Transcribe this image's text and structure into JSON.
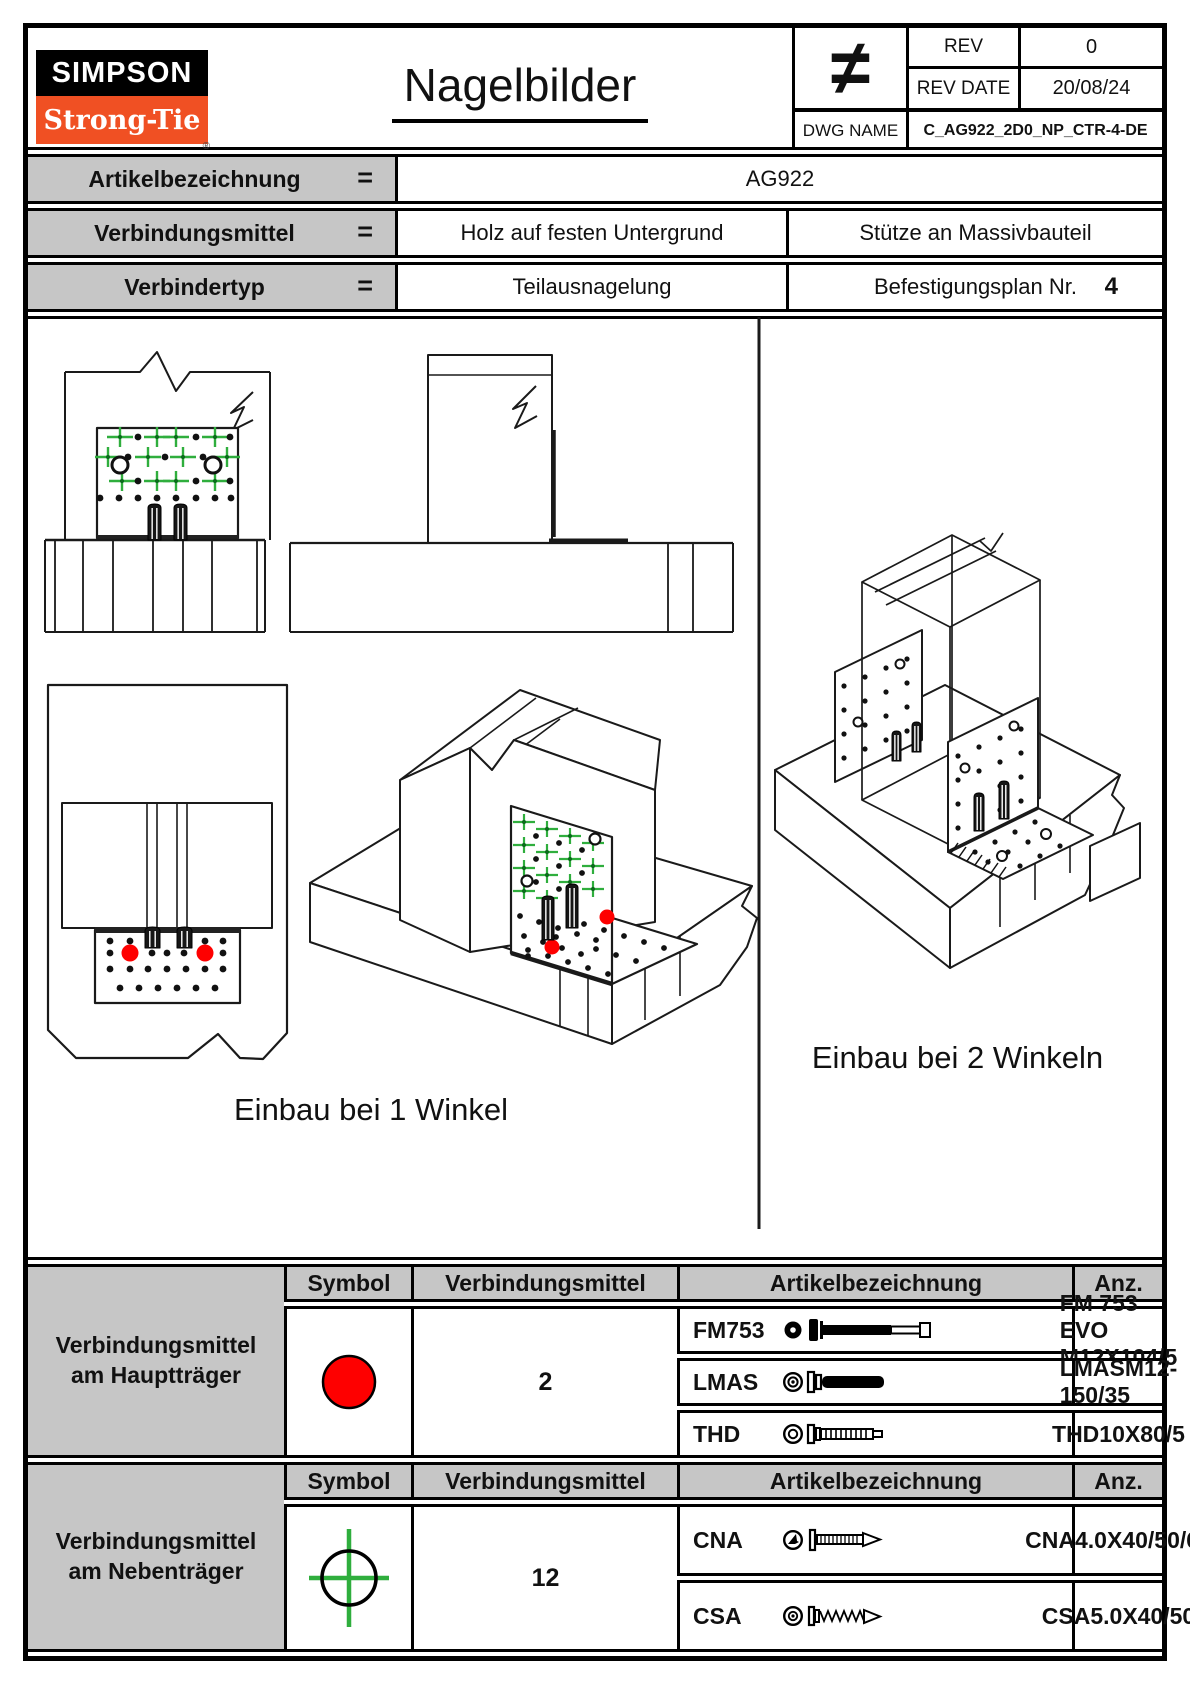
{
  "header": {
    "logo_line1": "SIMPSON",
    "logo_line2": "Strong-Tie",
    "registered_mark": "®",
    "title": "Nagelbilder",
    "symbol": "≠",
    "rev_label": "REV",
    "rev_value": "0",
    "rev_date_label": "REV DATE",
    "rev_date_value": "20/08/24",
    "dwg_label": "DWG NAME",
    "dwg_value": "C_AG922_2D0_NP_CTR-4-DE"
  },
  "info": {
    "rows": [
      {
        "label": "Artikelbezeichnung",
        "eq": "=",
        "value": "AG922"
      },
      {
        "label": "Verbindungsmittel",
        "eq": "=",
        "left": "Holz auf festen Untergrund",
        "right": "Stütze an Massivbauteil"
      },
      {
        "label": "Verbindertyp",
        "eq": "=",
        "left": "Teilausnagelung",
        "right": "Befestigungsplan Nr.",
        "plan_no": "4"
      }
    ]
  },
  "drawings": {
    "caption_one": "Einbau bei 1 Winkel",
    "caption_two": "Einbau bei 2 Winkeln"
  },
  "legend": {
    "headers": {
      "symbol": "Symbol",
      "fastener": "Verbindungsmittel",
      "article": "Artikelbezeichnung",
      "qty": "Anz."
    },
    "main_beam": {
      "label": "Verbindungsmittel am Hauptträger",
      "symbol_icon": "red-circle",
      "rows": [
        {
          "code": "FM753",
          "icon": "fm753-bolt-icon",
          "article": "FM 753 EVO M12X104/5"
        },
        {
          "code": "LMAS",
          "icon": "lmas-anchor-icon",
          "article": "LMASM12-150/35"
        },
        {
          "code": "THD",
          "icon": "thd-screw-icon",
          "article": "THD10X80/5"
        }
      ],
      "qty": "2"
    },
    "secondary_beam": {
      "label": "Verbindungsmittel am Nebenträger",
      "symbol_icon": "green-crosshair",
      "rows": [
        {
          "code": "CNA",
          "icon": "cna-nail-icon",
          "article": "CNA4.0X40/50/60"
        },
        {
          "code": "CSA",
          "icon": "csa-screw-icon",
          "article": "CSA5.0X40/50"
        }
      ],
      "qty": "12"
    }
  },
  "colors": {
    "nail_green": "#2fae3d",
    "anchor_red": "#fe0000",
    "brand_orange": "#f05023",
    "cell_gray": "#c6c6c6"
  }
}
